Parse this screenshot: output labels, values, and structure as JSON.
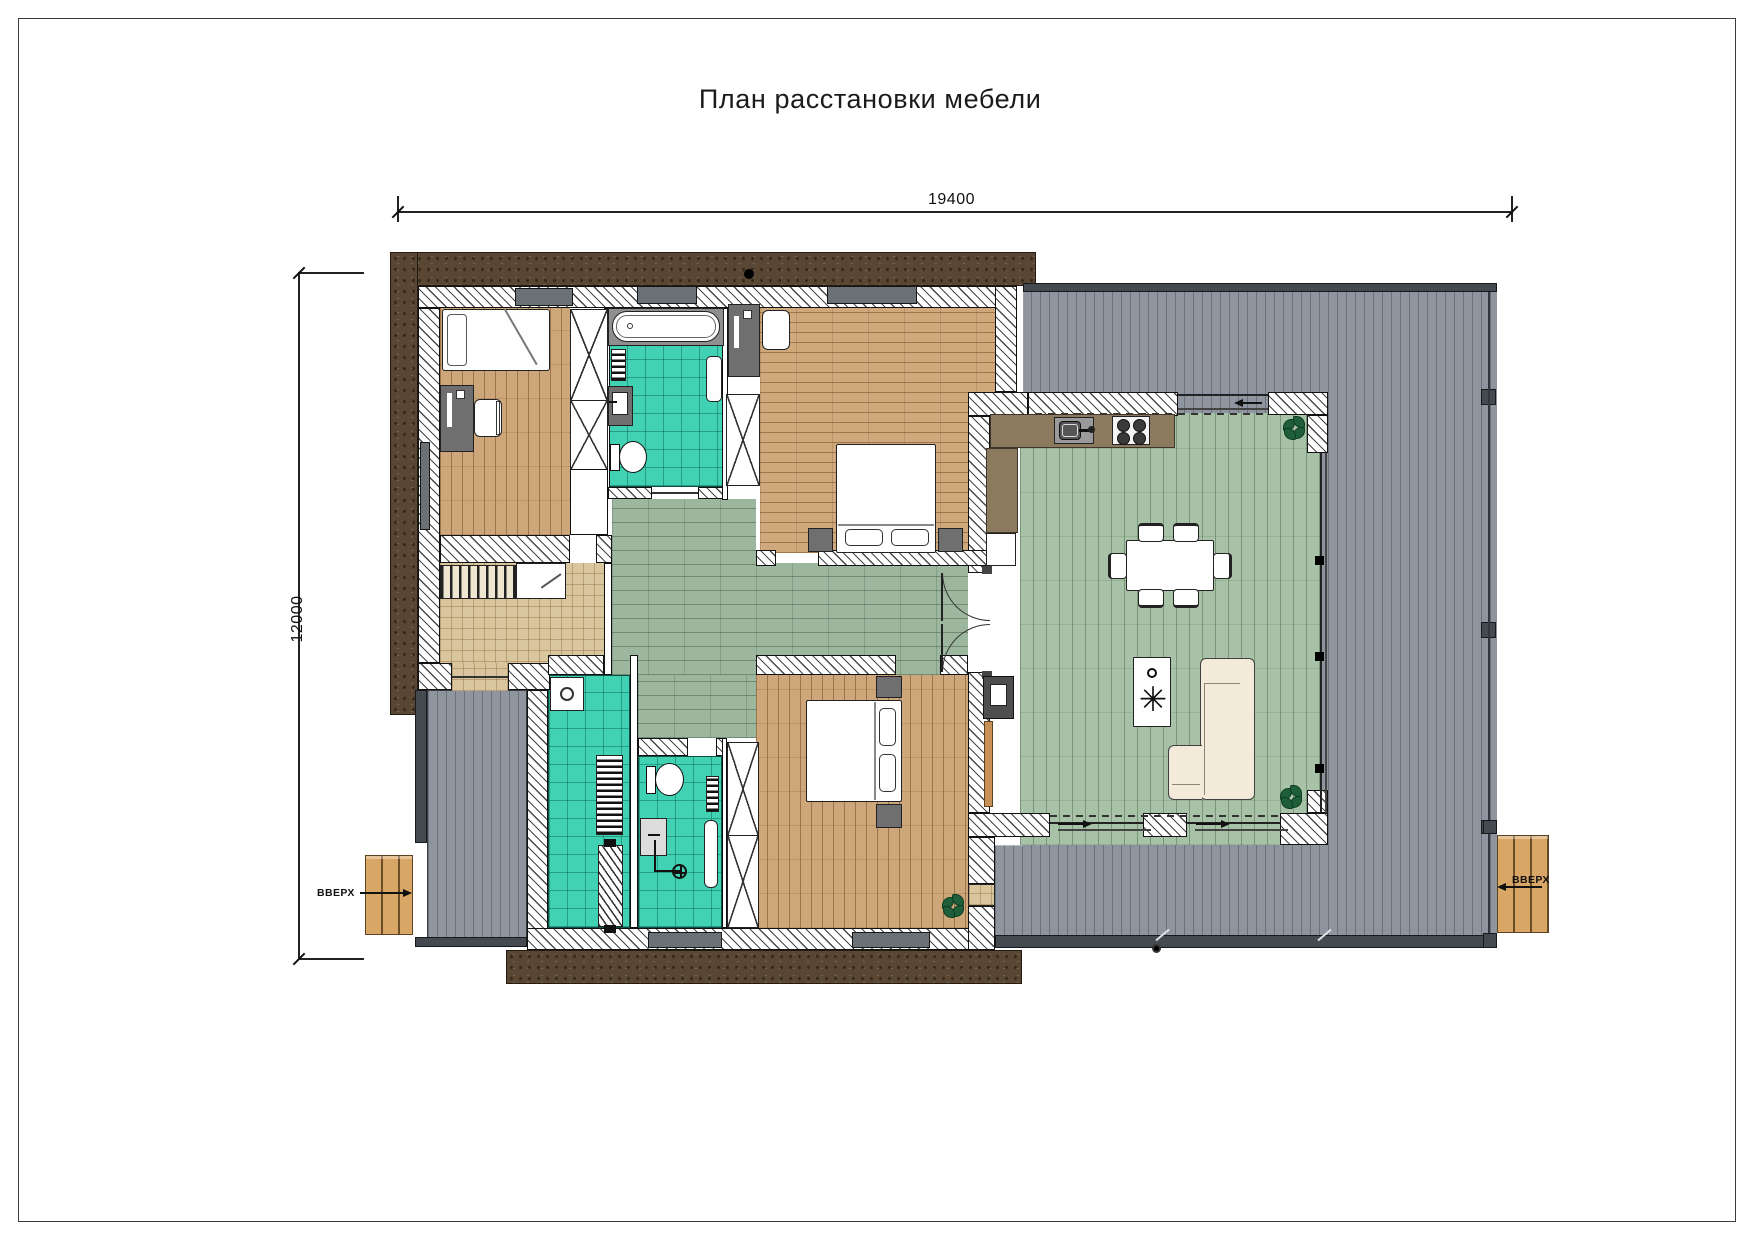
{
  "title": "План расстановки мебели",
  "dimensions": {
    "top": "19400",
    "left": "12000"
  },
  "labels": {
    "stairs_left": "ВВЕРХ",
    "stairs_right": "ВВЕРХ"
  },
  "palette": {
    "soil": "#5a4733",
    "deck_gray": "#8e959e",
    "wood_floor": "#cda77a",
    "tile_teal": "#40d2b2",
    "tile_tan": "#d9c69e",
    "hall_green": "#9db79f",
    "living_green": "#a8c2a7",
    "kitchen_counter": "#8b7a5e",
    "sofa_cream": "#f4ead9",
    "steps_wood": "#d9a765",
    "wall_hatch": "#474747"
  },
  "rooms": [
    {
      "id": "bedroom-1",
      "floor": "wood-plank"
    },
    {
      "id": "bathroom-1",
      "floor": "teal-tile"
    },
    {
      "id": "bedroom-2",
      "floor": "wood-plank"
    },
    {
      "id": "entry-hall",
      "floor": "tan-tile"
    },
    {
      "id": "hallway",
      "floor": "green-tile"
    },
    {
      "id": "laundry",
      "floor": "teal-tile"
    },
    {
      "id": "bathroom-2",
      "floor": "teal-tile"
    },
    {
      "id": "bedroom-3",
      "floor": "wood-plank"
    },
    {
      "id": "living-kitchen",
      "floor": "green-plank"
    },
    {
      "id": "terrace-right",
      "floor": "deck"
    },
    {
      "id": "terrace-left",
      "floor": "deck"
    }
  ]
}
